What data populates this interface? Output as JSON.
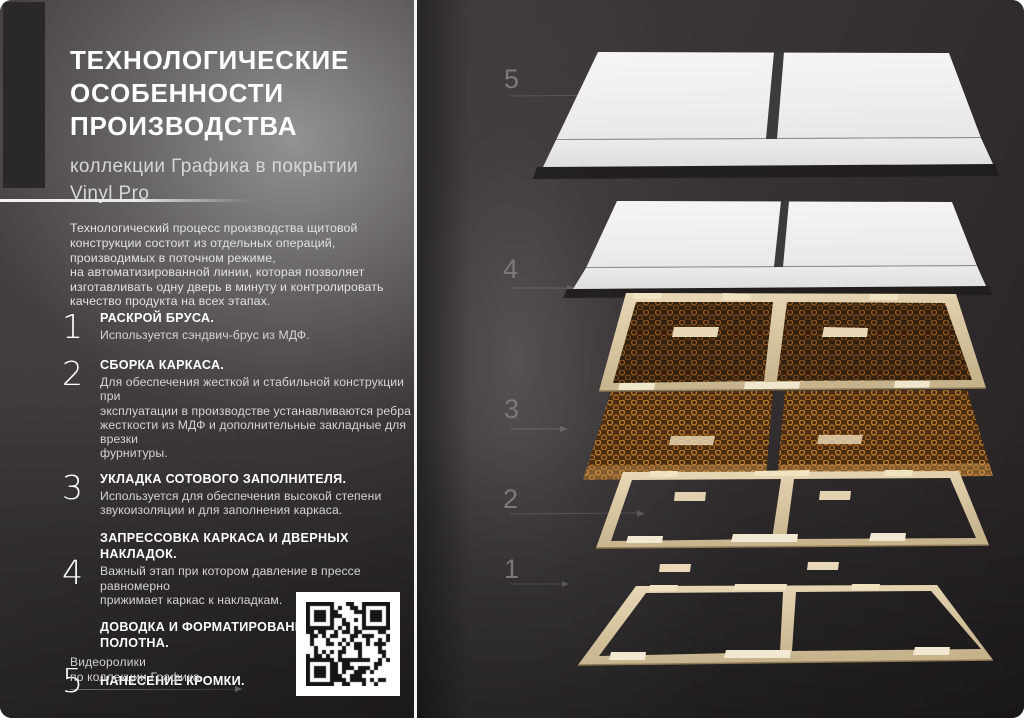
{
  "title": "ТЕХНОЛОГИЧЕСКИЕ\nОСОБЕННОСТИ\nПРОИЗВОДСТВА",
  "subtitle": "коллекции Графика в покрытии\nVinyl Pro",
  "intro": "Технологический процесс производства щитовой\nконструкции состоит из отдельных операций,\nпроизводимых в поточном режиме,\nна автоматизированной линии, которая позволяет\nизготавливать одну дверь в минуту и контролировать\nкачество продукта на всех этапах.",
  "steps": [
    {
      "num": "1",
      "title": "РАСКРОЙ БРУСА.",
      "body": "Используется сэндвич-брус из МДФ."
    },
    {
      "num": "2",
      "title": "СБОРКА КАРКАСА.",
      "body": "Для обеспечения жесткой и стабильной конструкции при\nэксплуатации в производстве устанавливаются ребра\nжесткости из МДФ и дополнительные закладные для врезки\nфурнитуры."
    },
    {
      "num": "3",
      "title": "УКЛАДКА СОТОВОГО ЗАПОЛНИТЕЛЯ.",
      "body": "Используется для обеспечения высокой степени\nзвукоизоляции и для заполнения каркаса."
    },
    {
      "num": "4",
      "title": "ЗАПРЕССОВКА КАРКАСА И ДВЕРНЫХ НАКЛАДОК.",
      "body": "Важный этап при котором давление в прессе равномерно\nприжимает каркас к накладкам.",
      "title2": "ДОВОДКА И ФОРМАТИРОВАНИЕ ДВЕРНОГО\nПОЛОТНА."
    },
    {
      "num": "5",
      "title": "НАНЕСЕНИЕ КРОМКИ.",
      "body": ""
    }
  ],
  "footer": {
    "video_label": "Видеоролики\nпо коллекции Графика"
  },
  "diagram": {
    "labels": [
      "5",
      "4",
      "3",
      "2",
      "1"
    ]
  },
  "colors": {
    "panel_white": "#f2f1f0",
    "frame_tan": "#dcc9a4",
    "honeycomb_wall": "#9a5f26",
    "honeycomb_bg": "#32200f",
    "accent_bar": "#2b2829",
    "text_primary": "#ffffff",
    "text_secondary": "#d6d4d5"
  }
}
